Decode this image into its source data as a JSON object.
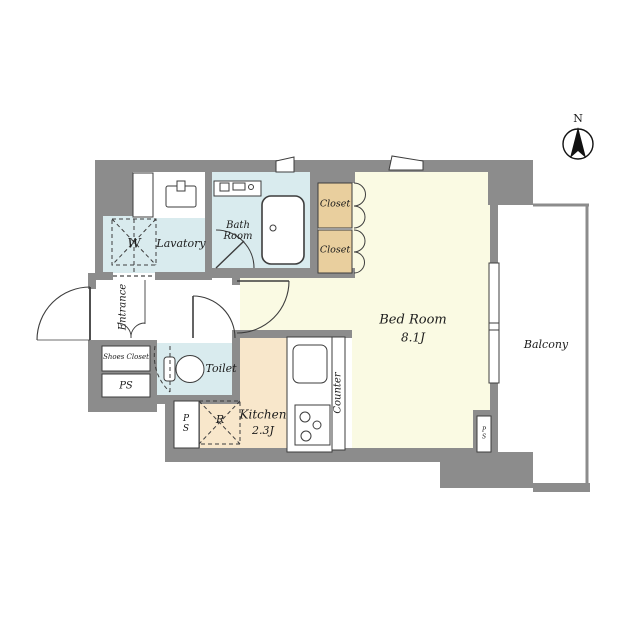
{
  "page": {
    "background": "#ffffff"
  },
  "colors": {
    "wall": "#8c8c8c",
    "room-cream": "#fafae3",
    "kitchen-peach": "#f8e7cb",
    "closet-tan": "#e9cf9e",
    "water-blue": "#d9ebee",
    "line": "#3d3d3d",
    "balcony-white": "#ffffff"
  },
  "compass": {
    "north_label": "N"
  },
  "rooms": {
    "bedroom": {
      "name": "Bed Room",
      "size": "8.1J"
    },
    "kitchen": {
      "name": "Kitchen",
      "size": "2.3J"
    },
    "balcony": {
      "name": "Balcony"
    },
    "bathroom": {
      "name": "Bath\nRoom"
    },
    "lavatory": {
      "name": "Lavatory"
    },
    "toilet": {
      "name": "Toilet"
    },
    "entrance": {
      "name": "Entrance"
    },
    "shoes_closet": {
      "name": "Shoes Closet"
    },
    "closet_upper": {
      "name": "Closet"
    },
    "closet_lower": {
      "name": "Closet"
    },
    "counter": {
      "name": "Counter"
    },
    "washing_machine": {
      "abbr": "W"
    },
    "refrigerator": {
      "abbr": "R"
    },
    "pipe_space_entrance": {
      "abbr": "PS"
    },
    "pipe_space_kitchen": {
      "abbr": "P\nS"
    },
    "pipe_space_balcony": {
      "abbr": "P\nS"
    }
  }
}
